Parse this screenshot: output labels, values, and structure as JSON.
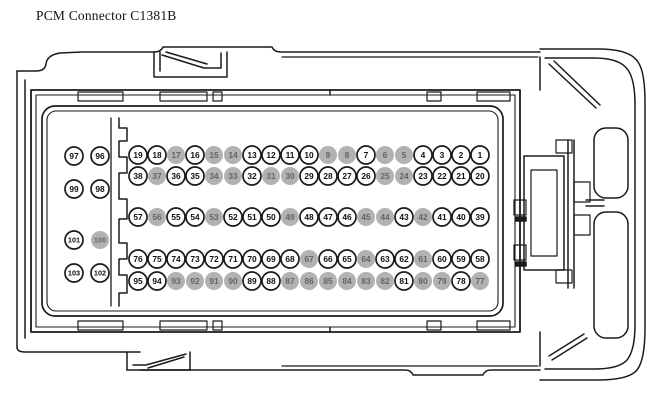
{
  "title": "PCM Connector C1381B",
  "colors": {
    "background": "#ffffff",
    "line": "#1b1b1b",
    "pin_fill": "#ffffff",
    "pin_text": "#111111",
    "pin_shaded_fill": "#b2b2b2",
    "pin_shaded_text": "#646464"
  },
  "connector": {
    "main_grid_rows": [
      {
        "numbers": [
          "19",
          "18",
          "17",
          "16",
          "15",
          "14",
          "13",
          "12",
          "11",
          "10",
          "9",
          "8",
          "7",
          "6",
          "5",
          "4",
          "3",
          "2",
          "1"
        ],
        "shaded": [
          false,
          false,
          true,
          false,
          true,
          true,
          false,
          false,
          false,
          false,
          true,
          true,
          false,
          true,
          true,
          false,
          false,
          false,
          false
        ]
      },
      {
        "numbers": [
          "38",
          "37",
          "36",
          "35",
          "34",
          "33",
          "32",
          "31",
          "30",
          "29",
          "28",
          "27",
          "26",
          "25",
          "24",
          "23",
          "22",
          "21",
          "20"
        ],
        "shaded": [
          false,
          true,
          false,
          false,
          true,
          true,
          false,
          true,
          true,
          false,
          false,
          false,
          false,
          true,
          true,
          false,
          false,
          false,
          false
        ]
      },
      {
        "numbers": [
          "57",
          "56",
          "55",
          "54",
          "53",
          "52",
          "51",
          "50",
          "49",
          "48",
          "47",
          "46",
          "45",
          "44",
          "43",
          "42",
          "41",
          "40",
          "39"
        ],
        "shaded": [
          false,
          true,
          false,
          false,
          true,
          false,
          false,
          false,
          true,
          false,
          false,
          false,
          true,
          true,
          false,
          true,
          false,
          false,
          false
        ]
      },
      {
        "numbers": [
          "76",
          "75",
          "74",
          "73",
          "72",
          "71",
          "70",
          "69",
          "68",
          "67",
          "66",
          "65",
          "64",
          "63",
          "62",
          "61",
          "60",
          "59",
          "58"
        ],
        "shaded": [
          false,
          false,
          false,
          false,
          false,
          false,
          false,
          false,
          false,
          true,
          false,
          false,
          true,
          false,
          false,
          true,
          false,
          false,
          false
        ]
      },
      {
        "numbers": [
          "95",
          "94",
          "93",
          "92",
          "91",
          "90",
          "89",
          "88",
          "87",
          "86",
          "85",
          "84",
          "83",
          "82",
          "81",
          "80",
          "79",
          "78",
          "77"
        ],
        "shaded": [
          false,
          false,
          true,
          true,
          true,
          true,
          false,
          false,
          true,
          true,
          true,
          true,
          true,
          true,
          false,
          true,
          true,
          false,
          true
        ]
      }
    ],
    "side_group_rows": [
      {
        "numbers": [
          "97",
          "96"
        ],
        "shaded": [
          false,
          false
        ]
      },
      {
        "numbers": [
          "99",
          "98"
        ],
        "shaded": [
          false,
          false
        ]
      },
      {
        "numbers": [
          "101",
          "100"
        ],
        "shaded": [
          false,
          true
        ]
      },
      {
        "numbers": [
          "103",
          "102"
        ],
        "shaded": [
          false,
          false
        ]
      }
    ]
  }
}
